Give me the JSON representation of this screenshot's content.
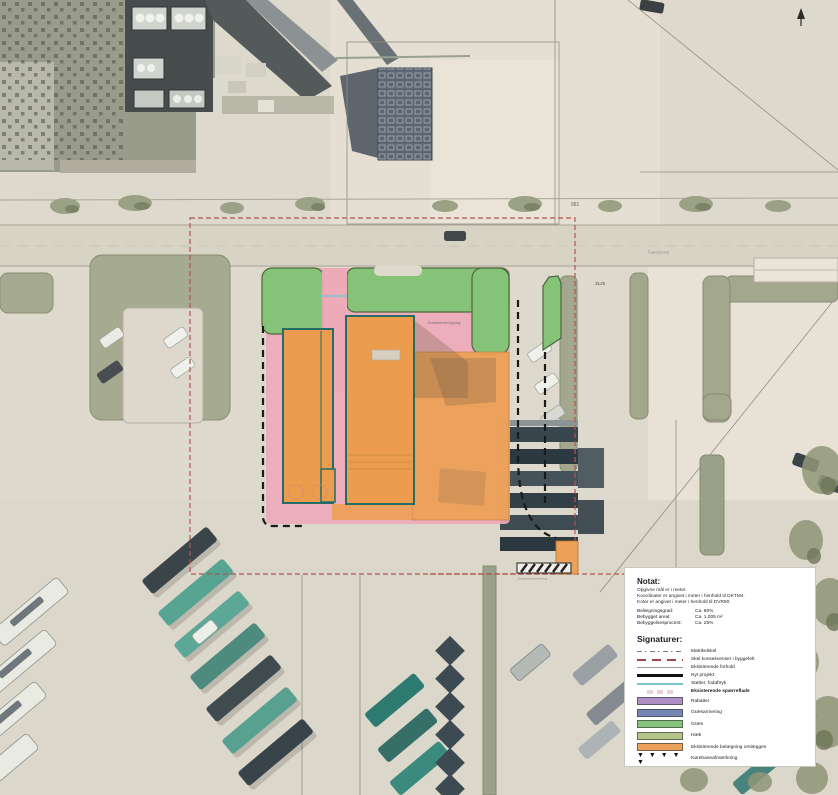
{
  "plan": {
    "road_number": "981",
    "parcel_number": "3125",
    "road_name": "Færgevej",
    "building_label": "Eksisterende bygning",
    "marking_caption": "Kørebaneafmærkning",
    "colors": {
      "graes": "#85c478",
      "haek": "#b5c489",
      "belaegning": "#edaab8",
      "omlaegges": "#eca158",
      "bygning": "#eb9c4c",
      "fodaftryk": "#7cc6d0",
      "skel": "#b05552",
      "byggefelt": "#1a1a1a"
    }
  },
  "notat": {
    "title": "Notat:",
    "lines": [
      "Opgivne mål er i meter.",
      "Koordinater er angivet i meter i henhold til DKTM4.",
      "Koter er angivet i meter i henhold til DVR90."
    ],
    "stats": [
      {
        "label": "Belægningsgrad:",
        "value": "Ca. 80%"
      },
      {
        "label": "Bebygget areal:",
        "value": "Ca. 1.005 m²"
      },
      {
        "label": "Bebyggelsesprocent:",
        "value": "Ca. 25%"
      }
    ]
  },
  "legend": {
    "title": "Signaturer:",
    "line_items": [
      {
        "label": "Matrikelskel"
      },
      {
        "label": "Skel konsekvenser i byggefelt"
      },
      {
        "label": "Eksisterende forhold"
      },
      {
        "label": "Nyt projekt"
      },
      {
        "label": "Støtter, fodaftryk"
      },
      {
        "label": "Eksisterende spærreflade"
      }
    ],
    "area_items": [
      {
        "label": "Rabatter",
        "color": "#ac90c6"
      },
      {
        "label": "Græsarmering",
        "color": "#7687b6"
      },
      {
        "label": "Græs",
        "color": "#86c47b"
      },
      {
        "label": "Hæk",
        "color": "#b5c489"
      },
      {
        "label": "Eksisterende belægning omlægges",
        "color": "#eca158"
      }
    ],
    "marker": {
      "symbol": "▼ ▼ ▼ ▼ ▼",
      "label": "Kørebaneafmærkning"
    }
  }
}
